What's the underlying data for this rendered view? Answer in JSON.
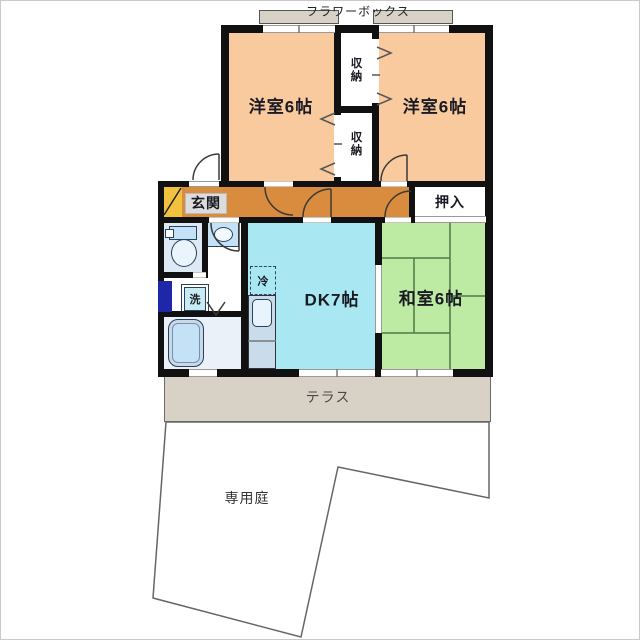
{
  "plan": {
    "type": "apartment-floor-plan",
    "labels": {
      "flower_box": "フラワーボックス",
      "bedroom_left": "洋室6帖",
      "bedroom_right": "洋室6帖",
      "storage_upper": "収納",
      "storage_lower": "収納",
      "genkan": "玄関",
      "oshiire": "押入",
      "dk": "DK7帖",
      "washitsu": "和室6帖",
      "fridge": "冷",
      "washer": "洗",
      "terrace": "テラス",
      "garden": "専用庭"
    },
    "colors": {
      "bedroom": "#F8CA9D",
      "corridor": "#D98C3E",
      "genkan": "#F2C23E",
      "dk": "#A9E7F2",
      "washitsu": "#BDEBA4",
      "terrace": "#D8D1C6",
      "fixture_blue": "#C4E1F5",
      "accent_navy": "#2026A8",
      "wall": "#111111",
      "tatami_line": "#4f7a44"
    }
  }
}
